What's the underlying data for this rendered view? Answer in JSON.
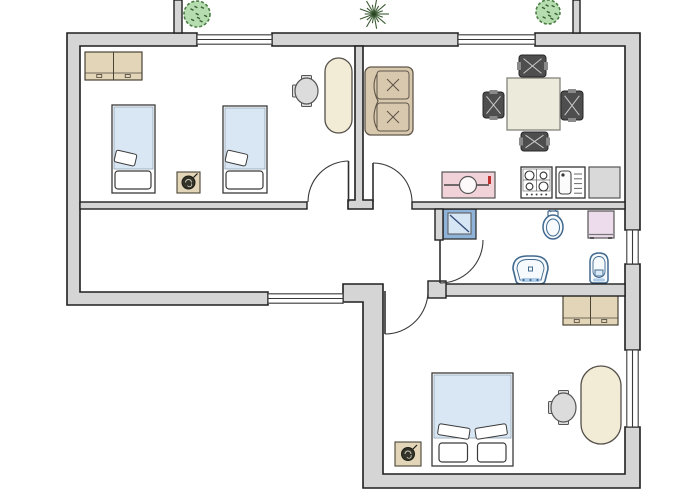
{
  "canvas": {
    "width": 700,
    "height": 500,
    "background": "#ffffff"
  },
  "palette": {
    "wall_fill": "#d5d5d5",
    "wall_stroke": "#1f1f1f",
    "line": "#3a3a3a",
    "bed_blue": "#d9e7f4",
    "bed_frame": "#ffffff",
    "tan": "#e3d5b8",
    "tan_stroke": "#4a4437",
    "desk_cream": "#f2ecd6",
    "sofa_tan": "#d8c8ae",
    "sofa_stroke": "#5f564a",
    "table_beige": "#eceadb",
    "table_stroke": "#8d8d85",
    "chair_dark": "#4e4e4e",
    "chair_dark_stroke": "#262626",
    "chair_hatch": "#c9c9c9",
    "office_chair": "#dcdcdc",
    "counter_pink": "#f1d2d8",
    "red_mark": "#c03030",
    "shower_blue": "#8fb2d8",
    "shower_inner": "#d7e6f5",
    "shower_line": "#35507a",
    "fixture_stroke": "#41698f",
    "fixture_fill": "#f6fafd",
    "fixture_shade": "#aecbe8",
    "cabinet_pink": "#ecdcec",
    "counter_gray": "#d9d9d9",
    "bush_fill": "#b5ddb0",
    "bush_stroke": "#4a7d42",
    "plant_dark": "#333329",
    "white": "#ffffff"
  },
  "walls": {
    "outer_paths": [
      {
        "name": "outer-wall-left",
        "d": "M67,33 L197,33 L197,46 L80,46 L80,292 L268,292 L268,305 L67,305 Z"
      },
      {
        "name": "outer-wall-top-middle",
        "d": "M272,33 L458,33 L458,46 L272,46 Z"
      },
      {
        "name": "outer-wall-top-right",
        "d": "M535,33 L640,33 L640,230 L625,230 L625,46 L535,46 Z"
      },
      {
        "name": "outer-wall-right-middle",
        "d": "M625,264 L640,264 L640,350 L625,350 Z"
      },
      {
        "name": "outer-wall-bottom",
        "d": "M343,284 L383,284 L383,474 L625,474 L625,427 L640,427 L640,488 L363,488 L363,302 L343,302 Z"
      }
    ],
    "inner_paths": [
      {
        "name": "interior-wall-bedroom1-living-divider",
        "d": "M355,46 L363,46 L363,200 L373,200 L373,209 L348,209 L348,200 L355,200 Z"
      }
    ],
    "rects": [
      {
        "name": "interior-wall-corridor-top",
        "x": 80,
        "y": 202,
        "w": 227,
        "h": 7
      },
      {
        "name": "interior-wall-kitchen-bathroom",
        "x": 412,
        "y": 202,
        "w": 213,
        "h": 7
      },
      {
        "name": "interior-wall-bathroom-left-stub",
        "x": 435,
        "y": 209,
        "w": 8,
        "h": 31
      },
      {
        "name": "interior-wall-bathroom-bottom",
        "x": 444,
        "y": 284,
        "w": 181,
        "h": 12
      },
      {
        "name": "interior-wall-bedroom2-door-jamb",
        "x": 428,
        "y": 281,
        "w": 18,
        "h": 17
      },
      {
        "name": "balcony-divider-left",
        "x": 174,
        "y": 0,
        "w": 8,
        "h": 33
      },
      {
        "name": "balcony-divider-right",
        "x": 573,
        "y": 0,
        "w": 7,
        "h": 33
      }
    ]
  },
  "windows": [
    {
      "name": "window-bedroom1-balcony",
      "x": 197,
      "y": 34,
      "w": 75,
      "h": 11,
      "dir": "h"
    },
    {
      "name": "window-living-balcony",
      "x": 458,
      "y": 34,
      "w": 77,
      "h": 11,
      "dir": "h"
    },
    {
      "name": "window-corridor-bottom",
      "x": 268,
      "y": 293,
      "w": 75,
      "h": 11,
      "dir": "h"
    },
    {
      "name": "window-bathroom-right",
      "x": 626,
      "y": 230,
      "w": 13,
      "h": 34,
      "dir": "v"
    },
    {
      "name": "window-bedroom2-right",
      "x": 626,
      "y": 350,
      "w": 13,
      "h": 77,
      "dir": "v"
    }
  ],
  "doors": [
    {
      "name": "door-bedroom1",
      "leaf": [
        348.5,
        202,
        348.5,
        161
      ],
      "arc": "M308,202 A41,41 0 0 1 348.5,161"
    },
    {
      "name": "door-living-room",
      "leaf": [
        373,
        202,
        373,
        163
      ],
      "arc": "M373,163 A39,39 0 0 1 412,202"
    },
    {
      "name": "door-bathroom",
      "leaf": [
        440,
        240,
        440,
        283
      ],
      "arc": "M440,283 A43,43 0 0 0 483,240"
    },
    {
      "name": "door-bedroom2",
      "leaf": [
        385,
        291,
        385,
        334
      ],
      "arc": "M428,291 A43,43 0 0 1 385,334"
    }
  ],
  "furniture": [
    {
      "type": "wardrobe",
      "name": "bedroom1-wardrobe",
      "x": 85,
      "y": 52,
      "w": 57,
      "h": 28
    },
    {
      "type": "bed_single",
      "name": "bedroom1-bed-left",
      "x": 112,
      "y": 105,
      "w": 43,
      "h": 88
    },
    {
      "type": "bed_single",
      "name": "bedroom1-bed-right",
      "x": 223,
      "y": 106,
      "w": 44,
      "h": 87
    },
    {
      "type": "plant_square",
      "name": "bedroom1-nightstand-plant",
      "x": 177,
      "y": 172,
      "w": 23,
      "h": 21
    },
    {
      "type": "office_chair",
      "name": "bedroom1-desk-chair",
      "x": 295,
      "y": 78,
      "w": 23,
      "h": 26
    },
    {
      "type": "desk",
      "name": "bedroom1-desk",
      "x": 325,
      "y": 58,
      "w": 27,
      "h": 75
    },
    {
      "type": "sofa",
      "name": "livingroom-sofa",
      "x": 365,
      "y": 67,
      "w": 48,
      "h": 68
    },
    {
      "type": "table",
      "name": "dining-table",
      "x": 507,
      "y": 78,
      "w": 53,
      "h": 52
    },
    {
      "type": "chair_dark",
      "name": "dining-chair-top",
      "x": 519,
      "y": 55,
      "w": 27,
      "h": 22,
      "o": "h"
    },
    {
      "type": "chair_dark",
      "name": "dining-chair-left",
      "x": 483,
      "y": 92,
      "w": 21,
      "h": 26,
      "o": "v"
    },
    {
      "type": "chair_dark",
      "name": "dining-chair-right",
      "x": 561,
      "y": 91,
      "w": 22,
      "h": 29,
      "o": "v"
    },
    {
      "type": "chair_dark",
      "name": "dining-chair-bottom",
      "x": 521,
      "y": 132,
      "w": 27,
      "h": 19,
      "o": "h"
    },
    {
      "type": "counter_pink",
      "name": "kitchen-counter-sink",
      "x": 442,
      "y": 172,
      "w": 53,
      "h": 26
    },
    {
      "type": "stove",
      "name": "kitchen-stove",
      "x": 521,
      "y": 167,
      "w": 31,
      "h": 31
    },
    {
      "type": "sink",
      "name": "kitchen-sink",
      "x": 556,
      "y": 167,
      "w": 29,
      "h": 31
    },
    {
      "type": "counter_gray",
      "name": "kitchen-fridge-counter",
      "x": 589,
      "y": 167,
      "w": 31,
      "h": 31
    },
    {
      "type": "shower",
      "name": "bathroom-shower",
      "x": 443,
      "y": 209,
      "w": 33,
      "h": 30
    },
    {
      "type": "toilet",
      "name": "bathroom-toilet",
      "x": 543,
      "y": 211,
      "w": 20,
      "h": 28
    },
    {
      "type": "cabinet",
      "name": "bathroom-cabinet",
      "x": 588,
      "y": 211,
      "w": 26,
      "h": 27
    },
    {
      "type": "washbasin",
      "name": "bathroom-washbasin",
      "x": 513,
      "y": 256,
      "w": 35,
      "h": 28
    },
    {
      "type": "bidet",
      "name": "bathroom-bidet",
      "x": 590,
      "y": 253,
      "w": 18,
      "h": 30
    },
    {
      "type": "wardrobe",
      "name": "bedroom2-wardrobe",
      "x": 563,
      "y": 294,
      "w": 55,
      "h": 31
    },
    {
      "type": "bed_double",
      "name": "bedroom2-double-bed",
      "x": 432,
      "y": 373,
      "w": 81,
      "h": 93
    },
    {
      "type": "plant_square",
      "name": "bedroom2-plant-table",
      "x": 395,
      "y": 442,
      "w": 26,
      "h": 24
    },
    {
      "type": "office_chair",
      "name": "bedroom2-desk-chair",
      "x": 551,
      "y": 393,
      "w": 25,
      "h": 29
    },
    {
      "type": "desk",
      "name": "bedroom2-desk",
      "x": 581,
      "y": 366,
      "w": 40,
      "h": 78
    }
  ],
  "plants": [
    {
      "type": "bush",
      "name": "balcony-bush-left",
      "cx": 197,
      "cy": 14,
      "r": 13
    },
    {
      "type": "spiky",
      "name": "balcony-plant-center",
      "cx": 374,
      "cy": 14,
      "r": 15
    },
    {
      "type": "bush",
      "name": "balcony-bush-right",
      "cx": 548,
      "cy": 12,
      "r": 12
    }
  ]
}
